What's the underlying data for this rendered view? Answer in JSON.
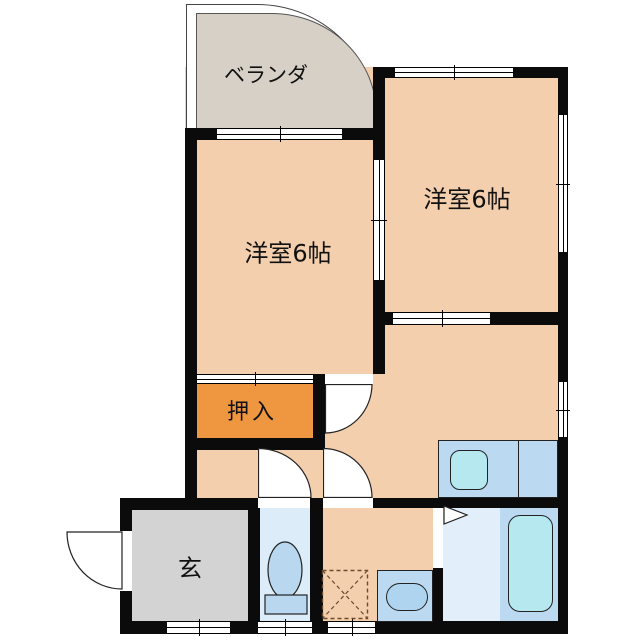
{
  "floorplan": {
    "rooms": [
      {
        "name": "veranda",
        "label": "ベランダ"
      },
      {
        "name": "western-room-right",
        "label": "洋室6帖"
      },
      {
        "name": "western-room-left",
        "label": "洋室6帖"
      },
      {
        "name": "closet",
        "label": "押入"
      },
      {
        "name": "entrance",
        "label": "玄"
      }
    ],
    "fixtures": [
      "kitchen-sink",
      "toilet",
      "washbasin",
      "washing-machine-space",
      "bathtub",
      "entrance-door",
      "folding-bath-door"
    ],
    "colors": {
      "room_fill": "#f3cfad",
      "veranda_fill": "#d6d0c6",
      "entrance_fill": "#d3d3d3",
      "closet_fill": "#ef9640",
      "wet_room_fill": "#dcecf8",
      "bath_floor_fill": "#e2eef9",
      "counter_fill": "#bcd9f2",
      "fixture_fill": "#b6e8f0",
      "wall": "#0b0b0b"
    }
  }
}
